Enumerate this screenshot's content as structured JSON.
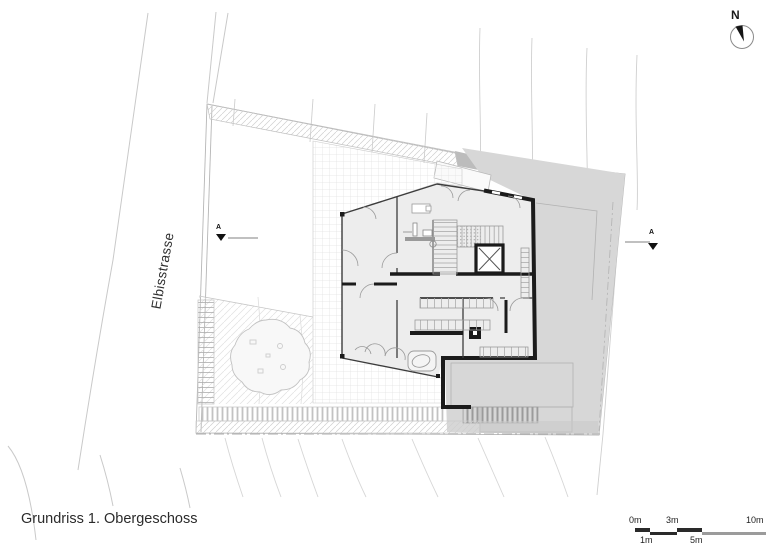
{
  "title": "Grundriss 1. Obergeschoss",
  "street": {
    "label": "Elbisstrasse"
  },
  "north_arrow": {
    "label": "N"
  },
  "section_markers": {
    "left_label": "A",
    "right_label": "A"
  },
  "scale_bar": {
    "m0": "0m",
    "m1": "1m",
    "m3": "3m",
    "m5": "5m",
    "m10": "10m"
  },
  "colors": {
    "wall_black": "#1b1b1b",
    "site_gray": "#d7d7d7",
    "room_fill": "#ededed",
    "scale_dark": "#2a2a2a",
    "scale_light": "#9b9b9b",
    "line_light": "#c9c9c9"
  }
}
